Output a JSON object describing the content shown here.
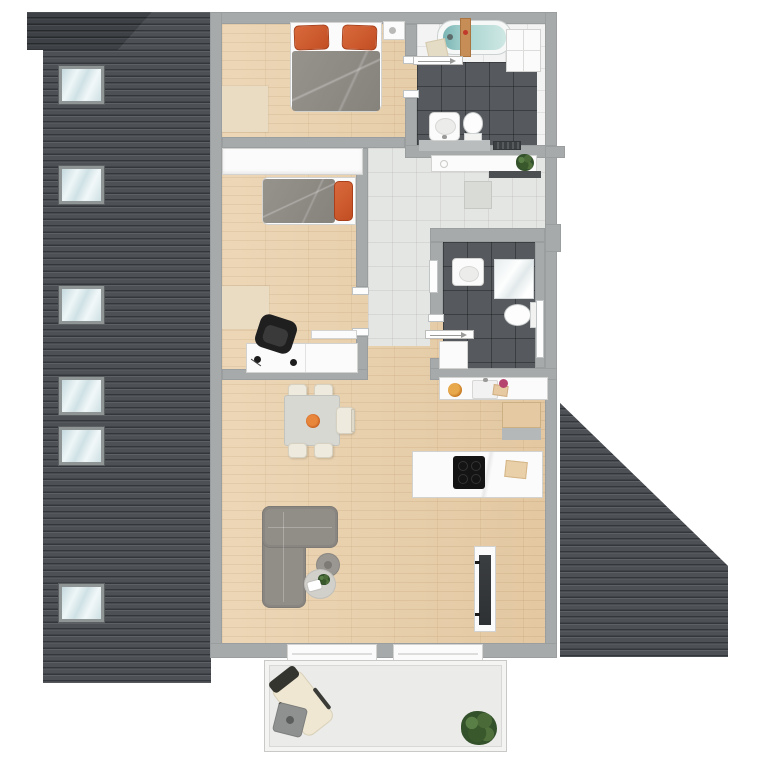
{
  "scene": {
    "kind": "apartment floor plan, top-down color rendering, attic storey",
    "canvas": {
      "width": 757,
      "height": 757
    },
    "visible_text": "none"
  },
  "palette": {
    "background": "#ffffff",
    "roof_tile": "#4d5054",
    "roof_ridge": "#3e4145",
    "wall_gray": "#a6aaab",
    "wood_floor": "#ead1ac",
    "hall_tile": "#e4e6e3",
    "bath_dark_tile": "#565a5e",
    "bath_white_tile": "#f2f3f2",
    "terrace_floor": "#ebebe9",
    "accent_pillow_orange": "#cc5a30",
    "duvet_gray": "#8e8a84",
    "sofa_gray": "#918d87",
    "bathtub_water_teal": "#a8d4d0",
    "cooktop_black": "#141414",
    "plant_green": "#3f6030",
    "skylight_glass": "#dceaed"
  },
  "roof": {
    "left": {
      "shape": "vertical band with darker ridge wedge top-left",
      "skylight_count": 6
    },
    "right": {
      "shape": "right triangle sloping down to the right",
      "skylight_count": 0
    }
  },
  "rooms": {
    "bedroom1": {
      "name": "bedroom-1 (top)",
      "floor": "wood",
      "furniture": [
        "double bed with gray duvet and two orange pillows",
        "nightstand with decor",
        "rug"
      ]
    },
    "bathroom1": {
      "name": "bathroom-1 (top right, en-suite)",
      "floor": "dark tile + white tile zone",
      "furniture": [
        "bathtub with teal water and wooden caddy",
        "bath mat",
        "wall shelf unit",
        "washbasin",
        "toilet",
        "counter",
        "dark radiator",
        "sliding door"
      ]
    },
    "hallway": {
      "name": "entry hall",
      "floor": "light tile",
      "furniture": [
        "white sideboard",
        "potted plant",
        "doormat",
        "entrance door (dark leaf)"
      ]
    },
    "bedroom2": {
      "name": "bedroom-2 (middle)",
      "floor": "wood",
      "furniture": [
        "wardrobe",
        "single bed with gray duvet and orange pillow",
        "rug",
        "desk with lamp",
        "black office chair",
        "room door leaf"
      ]
    },
    "bathroom2": {
      "name": "bathroom-2 (shower bath)",
      "floor": "dark tile",
      "furniture": [
        "washbasin",
        "glass shower",
        "toilet with cistern",
        "shower tray",
        "two radiators",
        "sliding door"
      ]
    },
    "living": {
      "name": "open living / dining / kitchen",
      "floor": "wood",
      "furniture": [
        "kitchen counter with sink, bowl and board",
        "tall cabinet",
        "kitchen island with black cooktop and cutting board",
        "dining table with orange bowl and five chairs",
        "L-shaped gray sofa",
        "round side table",
        "round coffee table with plant and tray",
        "TV lowboard with flat TV"
      ]
    },
    "terrace": {
      "name": "terrace (bottom)",
      "floor": "light stone",
      "furniture": [
        "sun lounger with dark head cushion",
        "small side table",
        "large potted plant"
      ]
    }
  },
  "openings": {
    "windows_bottom_wall": 2,
    "skylights_total": 6,
    "sliding_doors": 2,
    "hinged_door_openings": 2,
    "entrance_doors": 1
  }
}
